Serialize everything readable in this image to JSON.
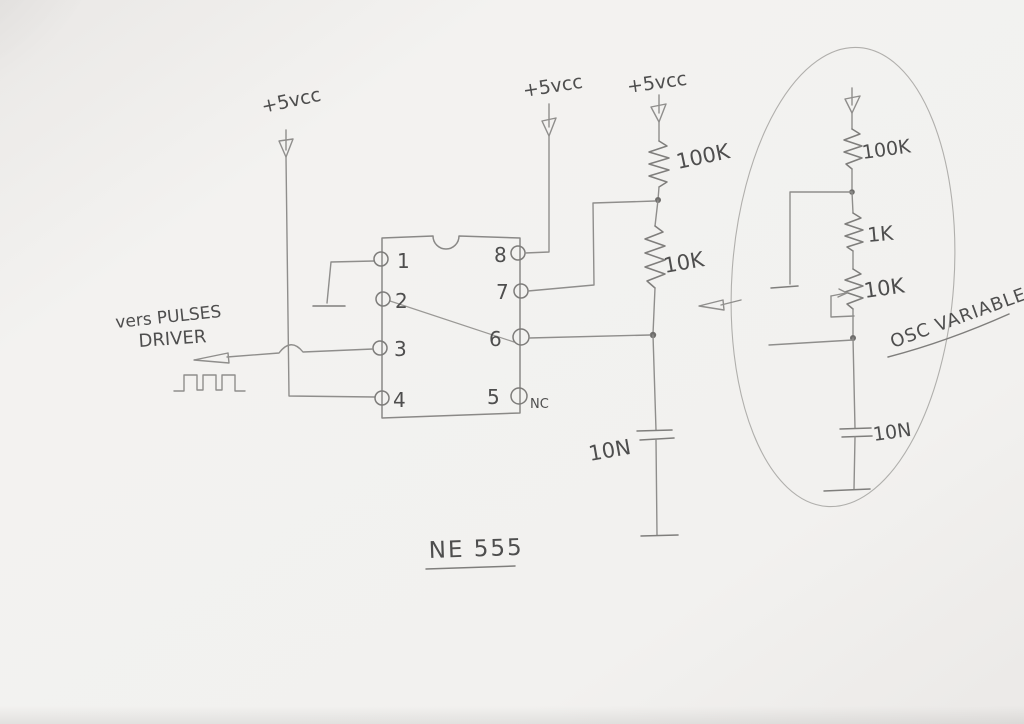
{
  "colors": {
    "paper": "#f2f1ef",
    "pencil_wire": "#8f8e8c",
    "pencil_component": "#7f7e7c",
    "handwriting": "#4e4e4e"
  },
  "diagram": {
    "chip_label": "NE 555",
    "output_caption_line1": "vers PULSES",
    "output_caption_line2": "DRIVER",
    "power_labels": {
      "left": "+5vcc",
      "middle": "+5vcc",
      "right": "+5vcc"
    },
    "ic": {
      "pins_left": [
        "1",
        "2",
        "3",
        "4"
      ],
      "pins_right": [
        "8",
        "7",
        "6",
        "5"
      ],
      "pin5_note": "NC"
    },
    "fixed_rc": {
      "r_top": "100K",
      "r_bottom": "10K",
      "cap": "10N"
    },
    "variable_rc": {
      "caption": "OSC VARIABLE",
      "r_top": "100K",
      "r_series": "1K",
      "pot": "10K",
      "cap": "10N"
    }
  }
}
